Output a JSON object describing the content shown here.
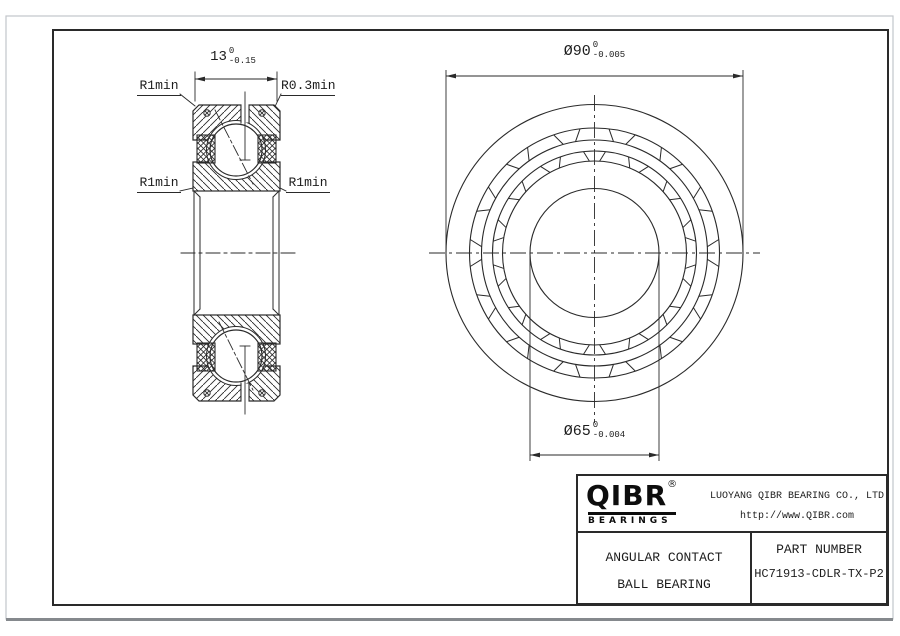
{
  "drawing": {
    "dimensions": {
      "width": {
        "text": "13",
        "tol_upper": "0",
        "tol_lower": "-0.15"
      },
      "outer_dia": {
        "text": "Ø90",
        "tol_upper": "0",
        "tol_lower": "-0.005"
      },
      "bore_dia": {
        "text": "Ø65",
        "tol_upper": "0",
        "tol_lower": "-0.004"
      }
    },
    "labels": {
      "fillet_top_left": "R1min",
      "fillet_top_right": "R0.3min",
      "fillet_mid_left": "R1min",
      "fillet_mid_right": "R1min"
    }
  },
  "title_block": {
    "logo_text": "QIBR",
    "logo_registered": "®",
    "logo_subtext": "BEARINGS",
    "company": "LUOYANG QIBR BEARING CO., LTD",
    "website": "http://www.QIBR.com",
    "product_line1": "ANGULAR CONTACT",
    "product_line2": "BALL BEARING",
    "part_number_label": "PART NUMBER",
    "part_number": "HC71913-CDLR-TX-P2"
  },
  "colors": {
    "line": "#2a2a2a",
    "sheet_edge": "#85898d"
  }
}
